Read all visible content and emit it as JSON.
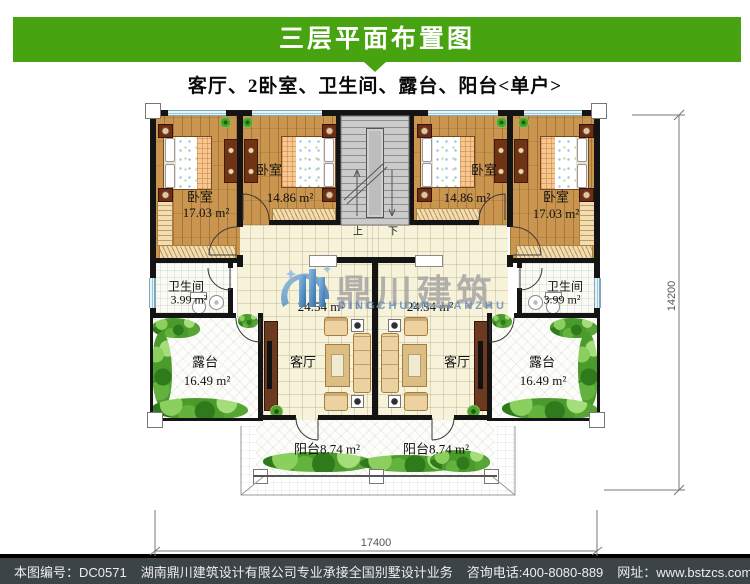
{
  "header": {
    "title": "三层平面布置图"
  },
  "subtitle": "客厅、2卧室、卫生间、露台、阳台<单户>",
  "watermark": {
    "cn": "鼎川建筑",
    "en": "DINGCHUAN JIANZHU"
  },
  "colors": {
    "banner_green": "#47a30f",
    "footer_bg": "#3d4448",
    "wall_black": "#141414",
    "wood_floor": "#c9954f",
    "tile_cream": "#f7f2da",
    "watermark_blue": "#4a86c0",
    "greenery_green": "#4a9a2c"
  },
  "plan": {
    "bedrooms": [
      {
        "label": "卧室",
        "area": "17.03 m²"
      },
      {
        "label": "卧室",
        "area": "14.86 m²"
      },
      {
        "label": "卧室",
        "area": "14.86 m²"
      },
      {
        "label": "卧室",
        "area": "17.03 m²"
      }
    ],
    "bathrooms": [
      {
        "label": "卫生间",
        "area": "3.99 m²"
      },
      {
        "label": "卫生间",
        "area": "3.99 m²"
      }
    ],
    "halls": [
      {
        "area": "24.54 m²"
      },
      {
        "area": "24.54 m²"
      }
    ],
    "livings": [
      {
        "label": "客厅"
      },
      {
        "label": "客厅"
      }
    ],
    "terraces": [
      {
        "label": "露台",
        "area": "16.49 m²"
      },
      {
        "label": "露台",
        "area": "16.49 m²"
      }
    ],
    "balconies": [
      {
        "label": "阳台8.74 m²"
      },
      {
        "label": "阳台8.74 m²"
      }
    ],
    "stairs": {
      "up": "上",
      "down": "下"
    },
    "dims": {
      "width": "17400",
      "height": "14200"
    }
  },
  "footer": {
    "code": "本图编号：DC0571",
    "company": "湖南鼎川建筑设计有限公司专业承接全国别墅设计业务",
    "phone": "咨询电话:400-8080-889",
    "website": "网址：www.bstzcs.com"
  }
}
